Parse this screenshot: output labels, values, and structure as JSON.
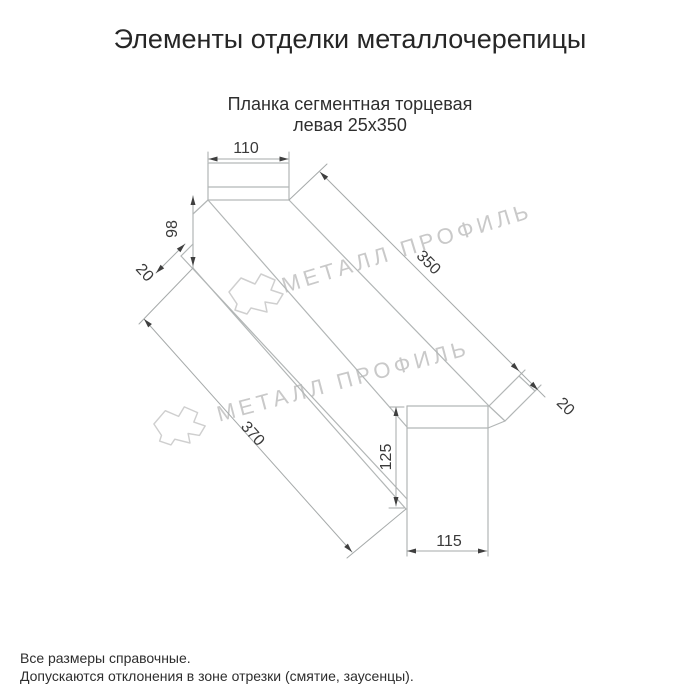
{
  "title": "Элементы отделки металлочерепицы",
  "product": {
    "line1": "Планка сегментная торцевая",
    "line2": "левая 25х350"
  },
  "dims": {
    "top_width": "110",
    "left_height": "98",
    "left_hem": "20",
    "length_top": "350",
    "right_hem": "20",
    "length_bottom": "370",
    "end_height": "125",
    "end_width": "115"
  },
  "watermark": {
    "text": "МЕТАЛЛ ПРОФИЛЬ"
  },
  "footer": {
    "line1": "Все размеры справочные.",
    "line2": "Допускаются отклонения в зоне отрезки (смятие, заусенцы)."
  },
  "colors": {
    "background": "#ffffff",
    "object_line": "#b2b6b6",
    "dimension_line": "#a6aaaa",
    "ink": "#3a3a3a",
    "watermark": "#c9c9c9"
  }
}
